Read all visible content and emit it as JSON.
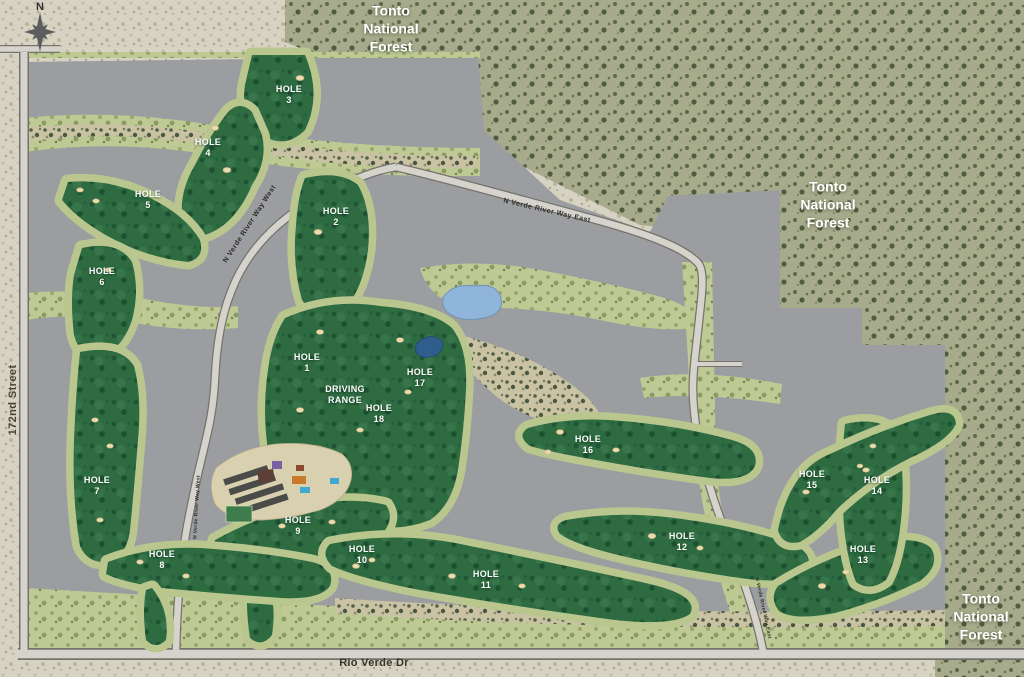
{
  "compass": {
    "label": "N"
  },
  "regions": {
    "forest_name": "Tonto\nNational\nForest"
  },
  "streets": {
    "west_street": "172nd Street",
    "south_street": "Rio Verde Dr",
    "northwest_road": "N Verde River Way West",
    "northeast_road": "N Verde River Way East"
  },
  "facilities": {
    "driving_range": "DRIVING\nRANGE"
  },
  "holes": [
    {
      "label": "HOLE",
      "number": "1"
    },
    {
      "label": "HOLE",
      "number": "2"
    },
    {
      "label": "HOLE",
      "number": "3"
    },
    {
      "label": "HOLE",
      "number": "4"
    },
    {
      "label": "HOLE",
      "number": "5"
    },
    {
      "label": "HOLE",
      "number": "6"
    },
    {
      "label": "HOLE",
      "number": "7"
    },
    {
      "label": "HOLE",
      "number": "8"
    },
    {
      "label": "HOLE",
      "number": "9"
    },
    {
      "label": "HOLE",
      "number": "10"
    },
    {
      "label": "HOLE",
      "number": "11"
    },
    {
      "label": "HOLE",
      "number": "12"
    },
    {
      "label": "HOLE",
      "number": "13"
    },
    {
      "label": "HOLE",
      "number": "14"
    },
    {
      "label": "HOLE",
      "number": "15"
    },
    {
      "label": "HOLE",
      "number": "16"
    },
    {
      "label": "HOLE",
      "number": "17"
    },
    {
      "label": "HOLE",
      "number": "18"
    }
  ],
  "colors": {
    "fairway_green": "#2e6b41",
    "apron_green": "#b9c78f",
    "parcel_gray": "#9b9da0",
    "desert_tan": "#d7d3c3",
    "forest_olive": "#a7ab8c",
    "water_blue": "#8fb6da",
    "label_white": "#ffffff"
  }
}
